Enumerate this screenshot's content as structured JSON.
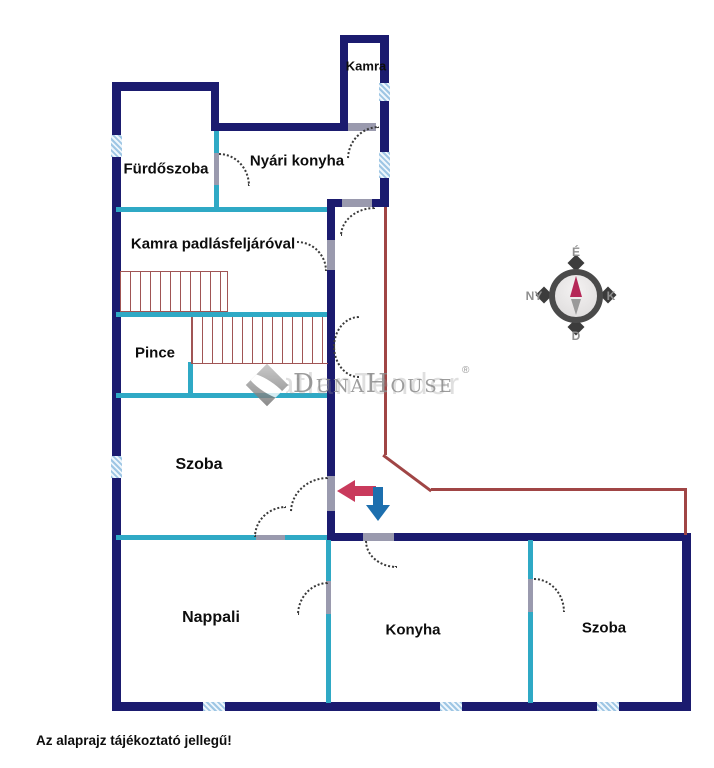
{
  "floorplan": {
    "rooms": [
      {
        "id": "kamra-top",
        "label": "Kamra"
      },
      {
        "id": "furdoszoba",
        "label": "Fürdőszoba"
      },
      {
        "id": "nyari-konyha",
        "label": "Nyári konyha"
      },
      {
        "id": "kamra-padlas",
        "label": "Kamra padlásfeljáróval"
      },
      {
        "id": "pince",
        "label": "Pince"
      },
      {
        "id": "szoba-left",
        "label": "Szoba"
      },
      {
        "id": "nappali",
        "label": "Nappali"
      },
      {
        "id": "konyha",
        "label": "Konyha"
      },
      {
        "id": "szoba-right",
        "label": "Szoba"
      }
    ],
    "compass": {
      "north": "É",
      "east": "K",
      "south": "D",
      "west": "NY"
    },
    "watermark": {
      "brand": "DunaHouse",
      "registered": "®",
      "echo": "IngatlanTender"
    },
    "note": "Az alaprajz tájékoztató jellegű!",
    "colors": {
      "outer_wall": "#1b1b6f",
      "partition_wall": "#2fa9c5",
      "boundary_line": "#a04545",
      "stairs": "#a05555",
      "arrow_red": "#c93a5c",
      "arrow_blue": "#1d6fae",
      "window_fill": "#9ec6e4"
    }
  }
}
